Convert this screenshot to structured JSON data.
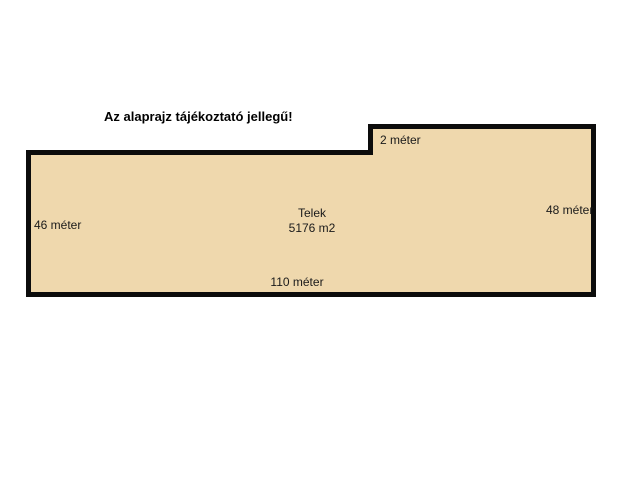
{
  "page": {
    "background_color": "#ffffff"
  },
  "disclaimer": "Az alaprajz tájékoztató jellegű!",
  "plot": {
    "fill_color": "#efd8ad",
    "border_color": "#0c0c0c",
    "name_label": "Telek",
    "area_label": "5176 m2",
    "dimensions": {
      "left_side": "46 méter",
      "right_side": "48 méter",
      "bottom_side": "110 méter",
      "notch_step": "2 méter"
    }
  }
}
